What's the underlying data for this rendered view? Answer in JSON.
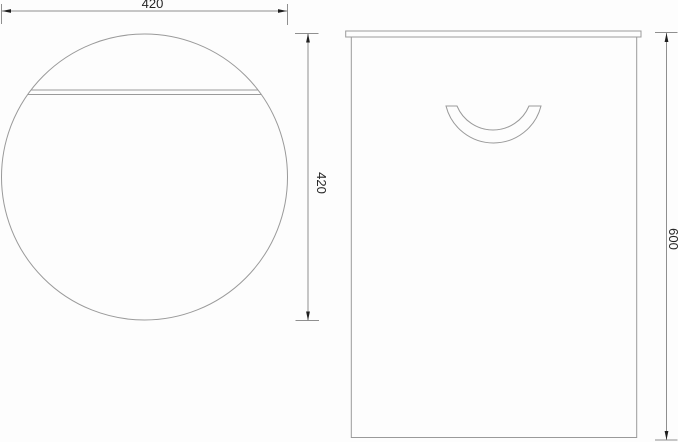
{
  "drawing": {
    "colors": {
      "background": "#fdfdfd",
      "line": "#9a9a9a",
      "dim_line": "#8f8f8f",
      "arrow": "#1f1f1f",
      "text": "#262626"
    },
    "dimensions": {
      "top_width": "420",
      "top_depth": "420",
      "front_height": "600"
    }
  }
}
